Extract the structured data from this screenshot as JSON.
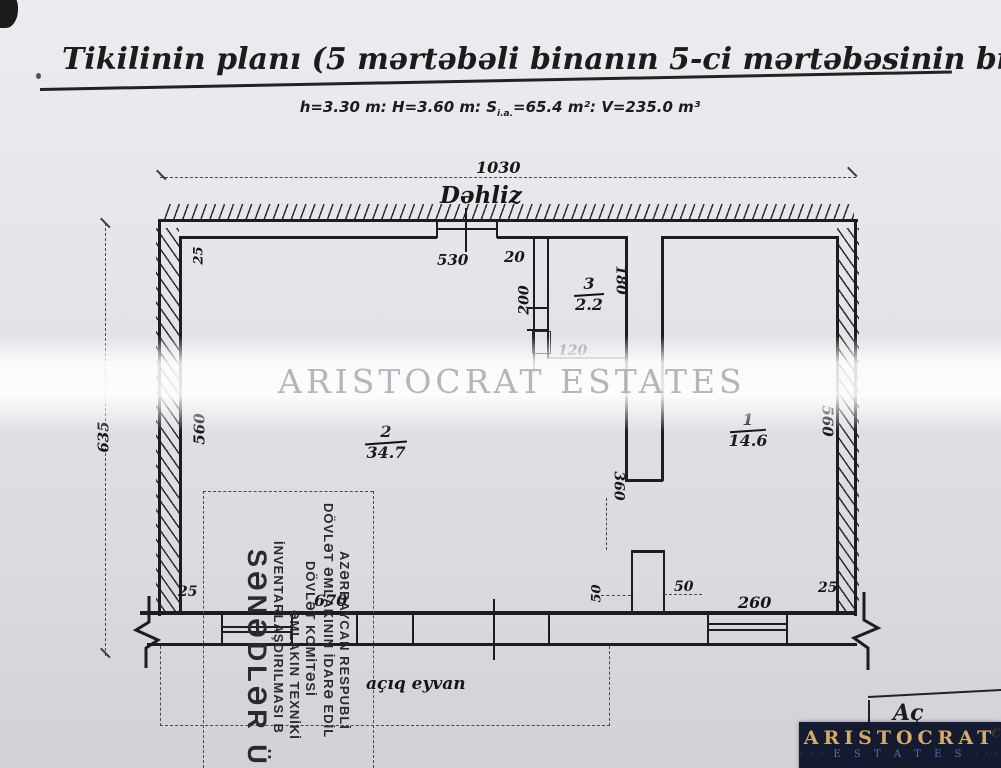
{
  "page": {
    "title": "Tikilinin planı (5 mərtəbəli binanın 5-ci mərtəbəsinin bir hissəsi)",
    "subtitle_pre": "h=3.30 m: H=3.60 m: S",
    "subtitle_sub": "i.a.",
    "subtitle_post": "=65.4 m²: V=235.0 m³"
  },
  "watermark": {
    "text": "ARISTOCRAT ESTATES"
  },
  "plan": {
    "corridor_label": "Dəhliz",
    "balcony_label": "açıq eyvan",
    "rooms": [
      {
        "number": "1",
        "area": "14.6"
      },
      {
        "number": "2",
        "area": "34.7"
      },
      {
        "number": "3",
        "area": "2.2"
      }
    ],
    "dims": {
      "overall_width": "1030",
      "overall_height": "635",
      "left_depth": "560",
      "right_depth": "560",
      "offset_top_left": "25",
      "room2_width": "530",
      "wall_thickness": "20",
      "partition_length": "200",
      "room3_depth": "180",
      "room3_width": "120",
      "mid_wall_length": "360",
      "offset_bottom_left": "25",
      "balcony_width": "670",
      "pier_depth": "50",
      "pier_width": "50",
      "room1_bottom_width": "260",
      "offset_bottom_right": "25"
    }
  },
  "stamp": {
    "lines": [
      "AZƏRBAYCAN RESPUBLİ",
      "DÖVLƏT ƏMLAKININ İDARƏ EDİL",
      "DÖVLƏT KOMİTƏSİ",
      "ƏMLAKIN TEXNİKİ",
      "İNVENTARLAŞDIRILMASI B",
      "SƏNƏDLƏR ÜÇ"
    ]
  },
  "logo": {
    "name": "ARISTOCRAT",
    "sub": "E S T A T E S",
    "dots": "· · ·"
  },
  "fragment": {
    "text": "Aç",
    "side": "c"
  }
}
